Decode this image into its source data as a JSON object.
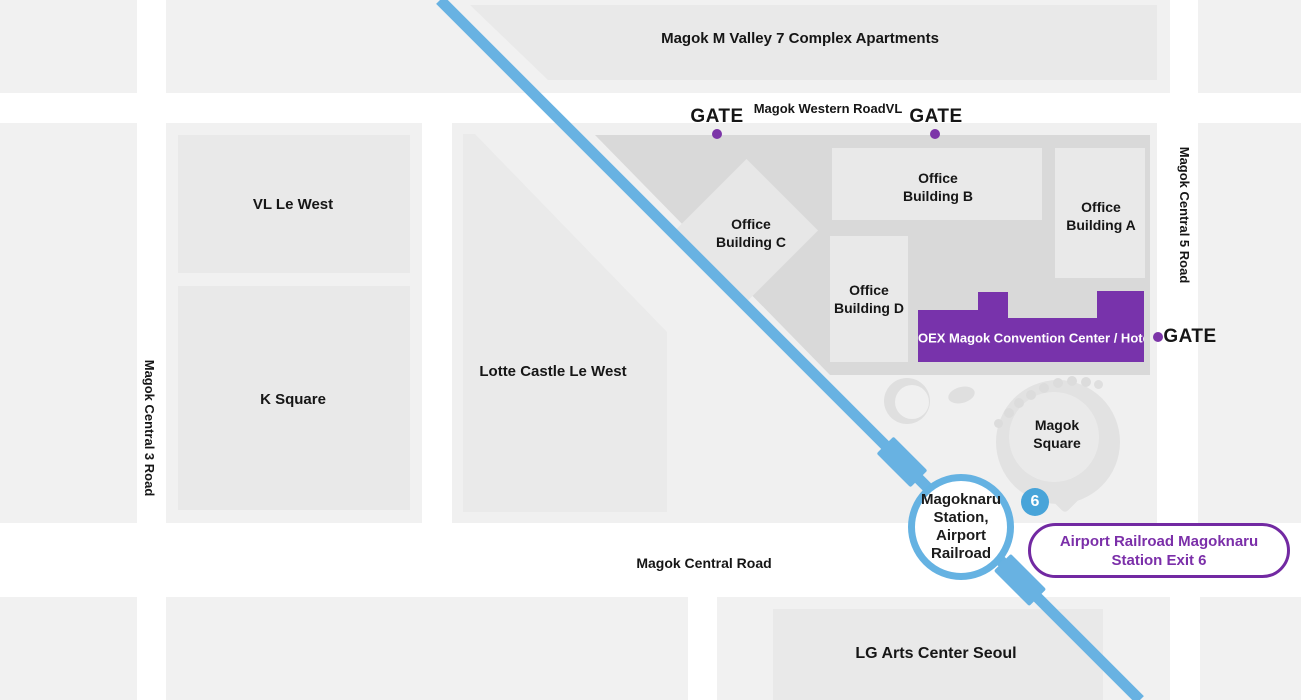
{
  "map": {
    "title_blocks": {
      "apartments": "Magok M Valley 7 Complex Apartments",
      "vl_le_west": "VL Le West",
      "k_square": "K Square",
      "lotte_castle": "Lotte Castle Le West",
      "lg_arts": "LG Arts Center Seoul"
    },
    "office_buildings": {
      "a": {
        "lines": [
          "Office",
          "Building A"
        ]
      },
      "b": {
        "lines": [
          "Office",
          "Building B"
        ]
      },
      "c": {
        "lines": [
          "Office",
          "Building C"
        ]
      },
      "d": {
        "lines": [
          "Office",
          "Building D"
        ]
      }
    },
    "coex": {
      "label": "COEX Magok Convention Center / Hotel"
    },
    "magok_square": {
      "lines": [
        "Magok",
        "Square"
      ]
    },
    "roads": {
      "western": "Magok Western RoadVL",
      "central": "Magok Central Road",
      "central_3": "Magok Central 3 Road",
      "central_5": "Magok Central 5 Road"
    },
    "gates": {
      "north_west": "GATE",
      "north_east": "GATE",
      "east": "GATE"
    },
    "station": {
      "lines": [
        "Magoknaru",
        "Station,",
        "Airport",
        "Railroad"
      ],
      "exit_badge": "6",
      "exit_label_lines": [
        "Airport Railroad Magoknaru",
        "Station Exit 6"
      ]
    },
    "colors": {
      "railway_blue": "#68b2e2",
      "station_ring_blue": "#65b2e2",
      "exit_badge_blue": "#48a4d9",
      "coex_purple": "#7833ab",
      "exit_box_purple": "#7229a2",
      "gate_dot_purple": "#7c35a8",
      "block_gray": "#f1f1f1",
      "building_gray": "#e9e9e9",
      "campus_gray": "#d9d9d9"
    }
  }
}
